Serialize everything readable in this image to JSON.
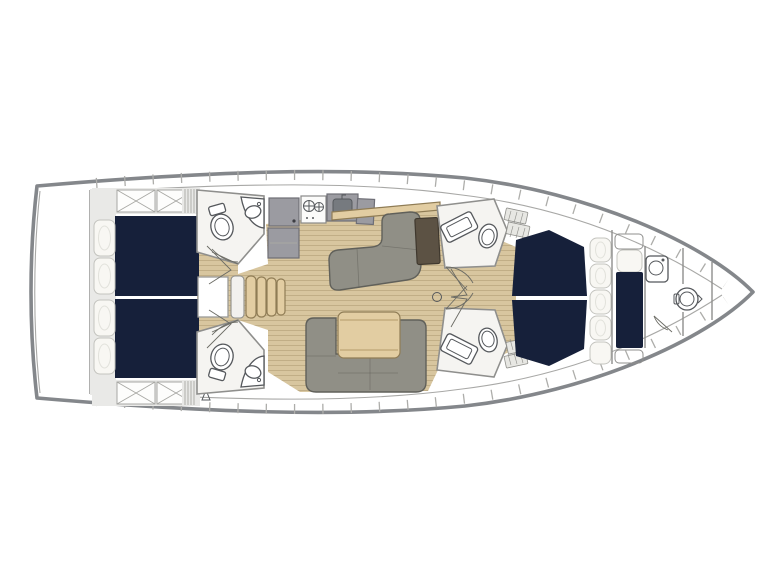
{
  "page": {
    "description": "Sailboat interior layout plan, top-down view, bow pointing right",
    "background": "#ffffff"
  },
  "colors": {
    "background": "#ffffff",
    "hull_outline": "#84878b",
    "inner_line": "#a8a8a6",
    "deck_band_divider": "#adadaa",
    "deck_gray": "#e9e9e7",
    "room_white": "#f5f4f1",
    "wall_line": "#8f8f8d",
    "berth_navy": "#16203a",
    "pillow_white": "#f8f7f3",
    "pillow_line": "#c4c4bf",
    "wood_floor": "#d8c69f",
    "wood_plank_line": "#bba87f",
    "wood_furniture": "#e2cda2",
    "wood_edge": "#8f7c55",
    "sofa_gray": "#908f86",
    "sofa_edge": "#60605a",
    "cabinet_gray": "#9b9ba1",
    "cabinet_edge": "#6e6e76",
    "sink_dark": "#767a7f",
    "chart_table_brown": "#5c5244",
    "fixture_line": "#55585c"
  },
  "plan": {
    "rooms": {
      "hull": {
        "label": "Sailboat hull outline, bow to the right"
      },
      "transom": {
        "label": "Transom and lazarette"
      },
      "aft_port_cabin": {
        "label": "Aft port cabin with double berth and pillows"
      },
      "aft_starboard_cabin": {
        "label": "Aft starboard cabin with double berth and pillows"
      },
      "aft_port_head": {
        "label": "Aft port head with toilet, sink and shower door"
      },
      "aft_starboard_head": {
        "label": "Aft starboard head with toilet, sink and shower door"
      },
      "companionway": {
        "label": "Companionway steps from cockpit"
      },
      "galley": {
        "label": "Galley with refrigerator, two-burner stove and sink"
      },
      "nav_area": {
        "label": "Navigation area with L-shaped settee and chart table"
      },
      "salon": {
        "label": "Salon with U-shaped settee and wooden table"
      },
      "forward_port_head": {
        "label": "Forward port head with vanity sink and toilet"
      },
      "forward_starboard_head": {
        "label": "Forward starboard head with vanity sink and toilet"
      },
      "forward_cabin": {
        "label": "Forward cabin with V double berth"
      },
      "bow_cabin": {
        "label": "Bow single-berth cabin"
      },
      "bow_head": {
        "label": "Bow head with sink and toilet"
      },
      "bow_locker": {
        "label": "Anchor locker at bow tip"
      },
      "mast": {
        "label": "Mast step ring on centerline"
      },
      "doors": {
        "label": "Door swing symbols"
      }
    }
  }
}
